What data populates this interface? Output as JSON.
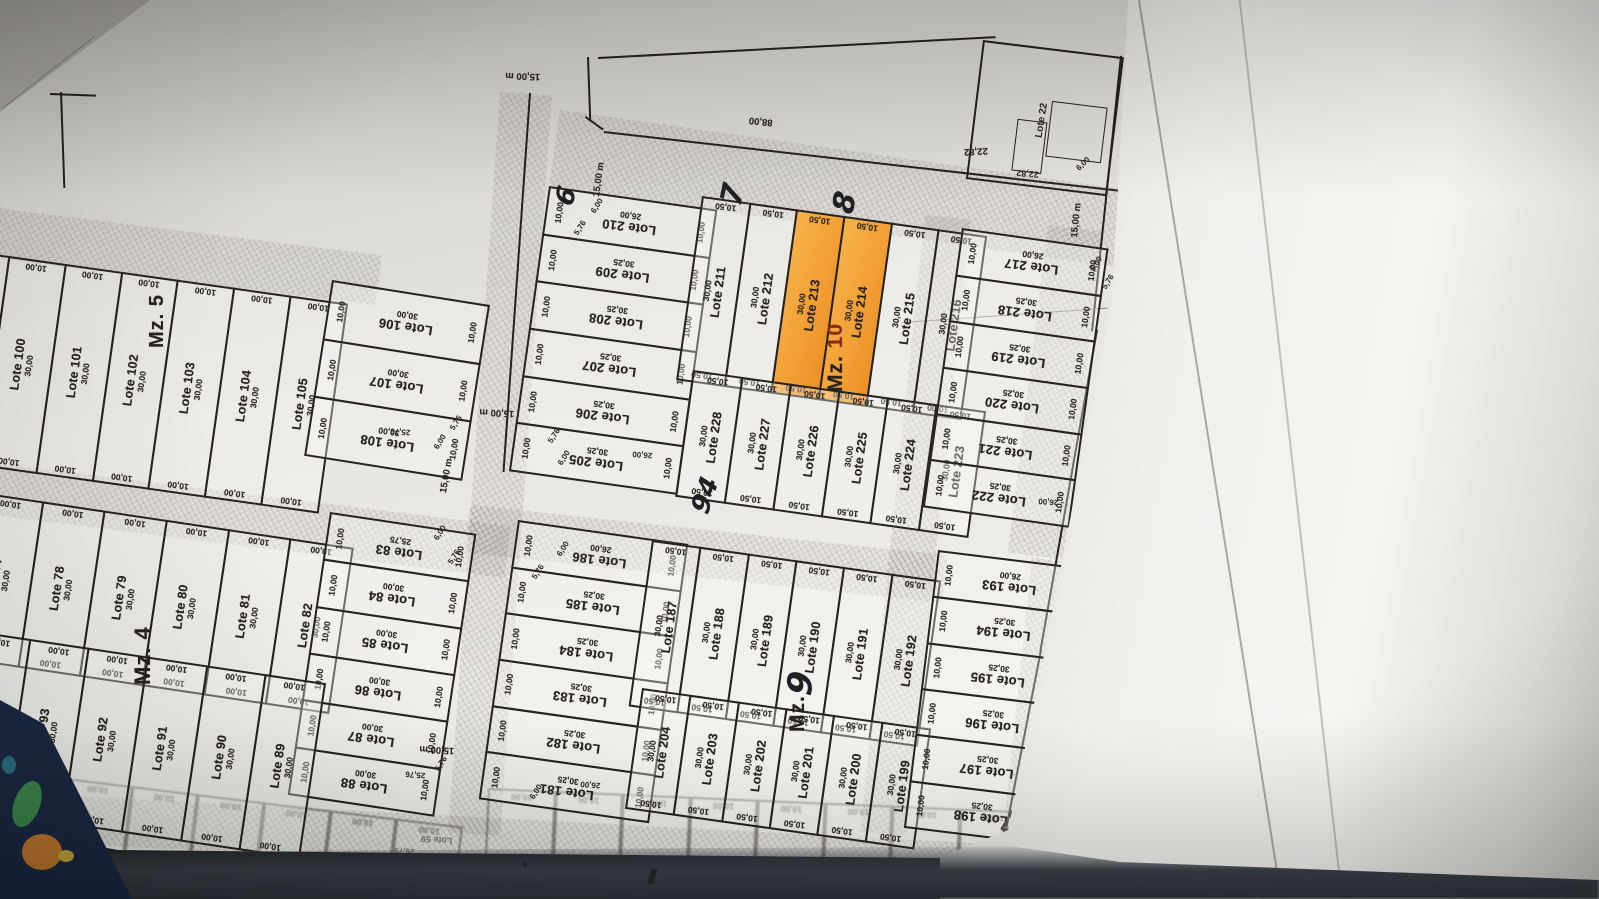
{
  "photo": {
    "paper": "#edece8",
    "ink": "#26221c",
    "highlight": "#f2a53b",
    "table": "#3a4147",
    "cover": "#1b2a44",
    "pencil": "#5a564f"
  },
  "blocks": {
    "mz5": {
      "row": {
        "lots": [
          {
            "n": "Lote 99",
            "l": "30,00",
            "a": "10,00",
            "b": "10,00"
          },
          {
            "n": "Lote 100",
            "l": "30,00",
            "a": "10,00",
            "b": "10,00"
          },
          {
            "n": "Lote 101",
            "l": "30,00",
            "a": "10,00",
            "b": "10,00"
          },
          {
            "n": "Lote 102",
            "l": "30,00",
            "a": "10,00",
            "b": "10,00"
          },
          {
            "n": "Lote 103",
            "l": "30,00",
            "a": "10,00",
            "b": "10,00"
          },
          {
            "n": "Lote 104",
            "l": "30,00",
            "a": "10,00",
            "b": "10,00"
          },
          {
            "n": "Lote 105",
            "l": "30,00",
            "a": "10,00",
            "b": "10,00"
          }
        ]
      },
      "col": {
        "lots": [
          {
            "n": "Lote 106",
            "l": "30,00",
            "a": "10,00",
            "b": "10,00"
          },
          {
            "n": "Lote 107",
            "l": "30,00",
            "a": "10,00",
            "b": "10,00"
          },
          {
            "n": "Lote 108",
            "l": "30,00",
            "a": "10,00",
            "b": "10,00"
          }
        ]
      }
    },
    "mz10": {
      "col": {
        "lots": [
          {
            "n": "Lote 210",
            "l": "26,00",
            "a": "10,00",
            "b": "10,00"
          },
          {
            "n": "Lote 209",
            "l": "30,25",
            "a": "10,00",
            "b": "10,00"
          },
          {
            "n": "Lote 208",
            "l": "30,25",
            "a": "10,00",
            "b": "10,00"
          },
          {
            "n": "Lote 207",
            "l": "30,25",
            "a": "10,00",
            "b": "10,00"
          },
          {
            "n": "Lote 206",
            "l": "30,25",
            "a": "10,00",
            "b": "10,00"
          },
          {
            "n": "Lote 205",
            "l": "30,25",
            "a": "10,00",
            "b": "10,00"
          }
        ]
      },
      "row_top": {
        "lots": [
          {
            "n": "Lote 211",
            "l": "30,00",
            "a": "10,50",
            "b": "10,50"
          },
          {
            "n": "Lote 212",
            "l": "30,00",
            "a": "10,50",
            "b": "10,50"
          },
          {
            "n": "Lote 213",
            "l": "30,00",
            "a": "10,50",
            "b": "10,50",
            "hl": true
          },
          {
            "n": "Lote 214",
            "l": "30,00",
            "a": "10,50",
            "b": "10,50",
            "hl": true
          },
          {
            "n": "Lote 215",
            "l": "30,00",
            "a": "10,50",
            "b": "10,50"
          },
          {
            "n": "Lote 216",
            "l": "30,00",
            "a": "10,50",
            "b": "10,00"
          }
        ]
      },
      "row_bottom": {
        "lots": [
          {
            "n": "Lote 228",
            "l": "30,00",
            "a": "10,50",
            "b": "10,50"
          },
          {
            "n": "Lote 227",
            "l": "30,00",
            "a": "10,50",
            "b": "10,50"
          },
          {
            "n": "Lote 226",
            "l": "30,00",
            "a": "10,50",
            "b": "10,50"
          },
          {
            "n": "Lote 225",
            "l": "30,00",
            "a": "10,50",
            "b": "10,50"
          },
          {
            "n": "Lote 224",
            "l": "30,00",
            "a": "10,50",
            "b": "10,50"
          },
          {
            "n": "Lote 223",
            "l": "30,00",
            "a": "10,50",
            "b": "10,50"
          }
        ]
      }
    },
    "mz8": {
      "col": {
        "lots": [
          {
            "n": "Lote 217",
            "l": "26,00",
            "a": "10,00",
            "b": "10,00"
          },
          {
            "n": "Lote 218",
            "l": "30,25",
            "a": "10,00",
            "b": "10,00"
          },
          {
            "n": "Lote 219",
            "l": "30,25",
            "a": "10,00",
            "b": "10,00"
          },
          {
            "n": "Lote 220",
            "l": "30,25",
            "a": "10,00",
            "b": "10,00"
          },
          {
            "n": "Lote 221",
            "l": "30,25",
            "a": "10,00",
            "b": "10,00"
          },
          {
            "n": "Lote 222",
            "l": "30,25",
            "a": "10,00",
            "b": "10,00"
          }
        ]
      }
    },
    "mz4": {
      "row_top": {
        "lots": [
          {
            "n": "Lote 77",
            "l": "30,00",
            "a": "10,00",
            "b": "10,00"
          },
          {
            "n": "Lote 78",
            "l": "30,00",
            "a": "10,00",
            "b": "10,00"
          },
          {
            "n": "Lote 79",
            "l": "30,00",
            "a": "10,00",
            "b": "10,00"
          },
          {
            "n": "Lote 80",
            "l": "30,00",
            "a": "10,00",
            "b": "10,00"
          },
          {
            "n": "Lote 81",
            "l": "30,00",
            "a": "10,00",
            "b": "10,00"
          },
          {
            "n": "Lote 82",
            "l": "30,00",
            "a": "10,00",
            "b": "10,00"
          }
        ]
      },
      "col": {
        "lots": [
          {
            "n": "Lote 83",
            "l": "25,75",
            "a": "10,00",
            "b": "10,00"
          },
          {
            "n": "Lote 84",
            "l": "30,00",
            "a": "10,00",
            "b": "10,00"
          },
          {
            "n": "Lote 85",
            "l": "30,00",
            "a": "10,00",
            "b": "10,00"
          },
          {
            "n": "Lote 86",
            "l": "30,00",
            "a": "10,00",
            "b": "10,00"
          },
          {
            "n": "Lote 87",
            "l": "30,00",
            "a": "10,00",
            "b": "10,00"
          },
          {
            "n": "Lote 88",
            "l": "30,00",
            "a": "10,00",
            "b": "10,00"
          }
        ]
      },
      "row_bottom": {
        "lots": [
          {
            "n": "Lote 94",
            "l": "30,00",
            "a": "10,00",
            "b": "10,00"
          },
          {
            "n": "Lote 93",
            "l": "30,00",
            "a": "10,00",
            "b": "10,00"
          },
          {
            "n": "Lote 92",
            "l": "30,00",
            "a": "10,00",
            "b": "10,00"
          },
          {
            "n": "Lote 91",
            "l": "30,00",
            "a": "10,00",
            "b": "10,00"
          },
          {
            "n": "Lote 90",
            "l": "30,00",
            "a": "10,00",
            "b": "10,00"
          },
          {
            "n": "Lote 89",
            "l": "30,00",
            "a": "10,00",
            "b": "10,00"
          }
        ]
      }
    },
    "mz9": {
      "col": {
        "lots": [
          {
            "n": "Lote 186",
            "l": "26,00",
            "a": "10,00",
            "b": "10,00"
          },
          {
            "n": "Lote 185",
            "l": "30,25",
            "a": "10,00",
            "b": "10,00"
          },
          {
            "n": "Lote 184",
            "l": "30,25",
            "a": "10,00",
            "b": "10,00"
          },
          {
            "n": "Lote 183",
            "l": "30,25",
            "a": "10,00",
            "b": "10,00"
          },
          {
            "n": "Lote 182",
            "l": "30,25",
            "a": "10,00",
            "b": "10,00"
          },
          {
            "n": "Lote 181",
            "l": "30,25",
            "a": "10,00",
            "b": "10,00"
          }
        ]
      },
      "row_top": {
        "lots": [
          {
            "n": "Lote 187",
            "l": "30,00",
            "a": "10,50",
            "b": "10,50"
          },
          {
            "n": "Lote 188",
            "l": "30,00",
            "a": "10,50",
            "b": "10,50"
          },
          {
            "n": "Lote 189",
            "l": "30,00",
            "a": "10,50",
            "b": "10,50"
          },
          {
            "n": "Lote 190",
            "l": "30,00",
            "a": "10,50",
            "b": "10,50"
          },
          {
            "n": "Lote 191",
            "l": "30,00",
            "a": "10,50",
            "b": "10,50"
          },
          {
            "n": "Lote 192",
            "l": "30,00",
            "a": "10,50",
            "b": "10,50"
          }
        ]
      },
      "row_bottom": {
        "lots": [
          {
            "n": "Lote 204",
            "l": "30,00",
            "a": "10,50",
            "b": "10,50"
          },
          {
            "n": "Lote 203",
            "l": "30,00",
            "a": "10,50",
            "b": "10,50"
          },
          {
            "n": "Lote 202",
            "l": "30,00",
            "a": "10,50",
            "b": "10,50"
          },
          {
            "n": "Lote 201",
            "l": "30,00",
            "a": "10,50",
            "b": "10,50"
          },
          {
            "n": "Lote 200",
            "l": "30,00",
            "a": "10,50",
            "b": "10,50"
          },
          {
            "n": "Lote 199",
            "l": "30,00",
            "a": "10,50",
            "b": "10,50"
          }
        ]
      }
    },
    "mz_right": {
      "col": {
        "lots": [
          {
            "n": "Lote 193",
            "l": "26,00",
            "a": "10,00",
            "b": "10,00"
          },
          {
            "n": "Lote 194",
            "l": "30,25",
            "a": "10,00",
            "b": "10,00"
          },
          {
            "n": "Lote 195",
            "l": "30,25",
            "a": "10,00",
            "b": "10,00"
          },
          {
            "n": "Lote 196",
            "l": "30,25",
            "a": "10,00",
            "b": "10,00"
          },
          {
            "n": "Lote 197",
            "l": "30,25",
            "a": "10,00",
            "b": "10,00"
          },
          {
            "n": "Lote 198",
            "l": "30,25",
            "a": "10,00",
            "b": "10,00"
          }
        ]
      }
    }
  },
  "mz_labels": {
    "mz5": "Mz. 5",
    "mz4": "Mz. 4",
    "mz9": "Mz.",
    "mz10_prefix": "Mz. ",
    "mz10_number": "10"
  },
  "street_labels": [
    {
      "text": "15,00 m"
    },
    {
      "text": "15,00 m"
    },
    {
      "text": "88,00"
    },
    {
      "text": "15,00 m"
    },
    {
      "text": "15,00 m"
    },
    {
      "text": "15,00 m"
    },
    {
      "text": "15,00 m"
    },
    {
      "text": "15,00 m"
    },
    {
      "text": "22,82"
    }
  ],
  "extra_dims": [
    "25,76",
    "5,76",
    "6,00",
    "6,00",
    "5,76",
    "26,00",
    "5,76",
    "6,00",
    "6,00",
    "5,76",
    "26,00",
    "5,76",
    "6,00",
    "6,00",
    "5,76",
    "25,76",
    "5,76",
    "6,00",
    "5,76",
    "26,00",
    "6,00",
    "6,00",
    "5,76"
  ],
  "handwritten": [
    "6",
    "7",
    "8",
    "9",
    "94",
    "E32"
  ],
  "corner_lot": {
    "name": "Lote 22",
    "dim_bottom": "22,82",
    "dim_corner": "6,00"
  },
  "faint": {
    "dim": "10,00",
    "right_label": "Lote 59",
    "right_len": "25,75"
  }
}
